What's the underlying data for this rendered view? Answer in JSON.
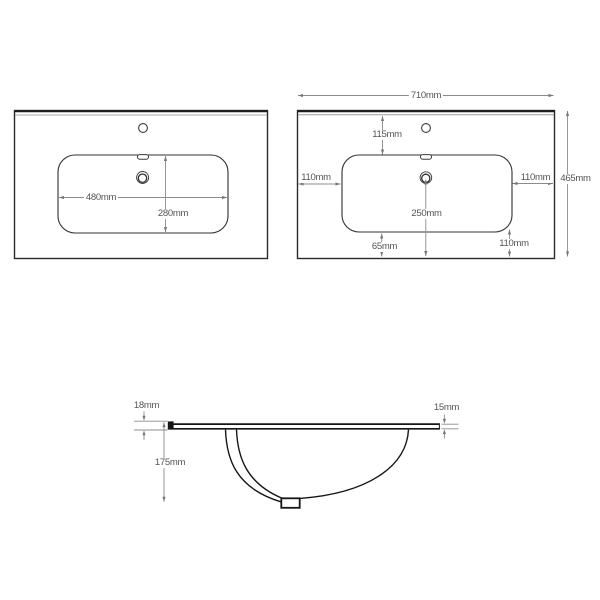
{
  "drawing": {
    "subject": "basin-countertop-technical-drawing",
    "line_color": "#2b2b2b",
    "dim_color": "#8c8c8c",
    "text_color": "#545454",
    "background": "#ffffff"
  },
  "views": {
    "left": {
      "name": "plan-view-basin",
      "dims": [
        {
          "id": "basin-width",
          "text": "480mm"
        },
        {
          "id": "basin-depth",
          "text": "280mm"
        }
      ]
    },
    "right": {
      "name": "plan-view-countertop-dimensioned",
      "dims": [
        {
          "id": "overall-width",
          "text": "710mm"
        },
        {
          "id": "overall-depth",
          "text": "465mm"
        },
        {
          "id": "tap-setback",
          "text": "115mm"
        },
        {
          "id": "left-margin",
          "text": "110mm"
        },
        {
          "id": "right-margin",
          "text": "110mm"
        },
        {
          "id": "drain-to-front",
          "text": "250mm"
        },
        {
          "id": "front-margin",
          "text": "65mm"
        },
        {
          "id": "corner-margin",
          "text": "110mm"
        }
      ]
    },
    "side": {
      "name": "side-section-view",
      "dims": [
        {
          "id": "front-edge-thickness",
          "text": "18mm"
        },
        {
          "id": "slab-thickness",
          "text": "15mm"
        },
        {
          "id": "bowl-depth",
          "text": "175mm"
        }
      ]
    }
  }
}
